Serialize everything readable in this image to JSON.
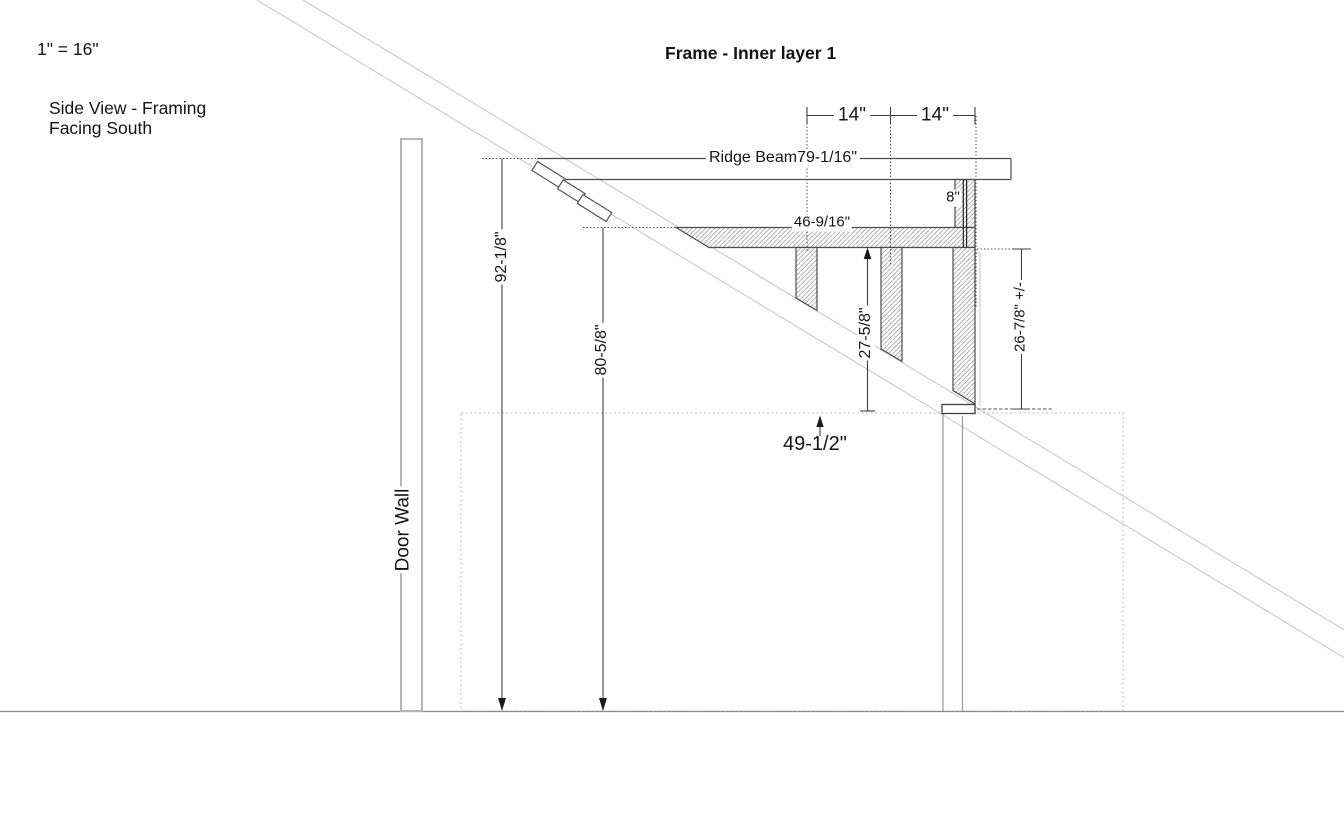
{
  "drawing": {
    "scale_note": "1\" = 16\"",
    "view_label_line1": "Side View - Framing",
    "view_label_line2": "Facing South",
    "title": "Frame - Inner layer 1",
    "door_wall_label": "Door Wall",
    "ridge_beam_label": "Ridge Beam79-1/16\"",
    "dimensions": {
      "beam_length": "46-9/16\"",
      "stud_spacing_left": "14\"",
      "stud_spacing_right": "14\"",
      "king_post_height": "8\"",
      "ridge_height": "92-1/8\"",
      "beam_top_height": "80-5/8\"",
      "post_height": "27-5/8\"",
      "right_post_height": "26-7/8\" +/-",
      "wall_height": "49-1/2\""
    },
    "colors": {
      "line_dark": "#3f3f3f",
      "rafter_gray": "#c8c8c8",
      "wall_gray": "#b5b5b5",
      "hatch_gray": "#9a9a9a",
      "ground_gray": "#8c8c8c",
      "text": "#141414"
    }
  }
}
